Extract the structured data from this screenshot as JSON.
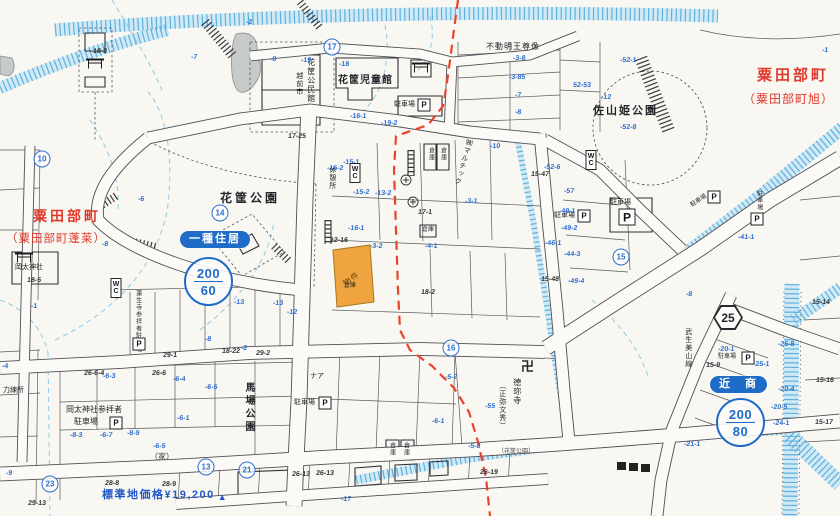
{
  "regions": {
    "top_right": {
      "name": "粟田部町",
      "sub": "（粟田部町旭）"
    },
    "west": {
      "name": "粟田部町",
      "sub": "（粟田部町蓬莱）"
    }
  },
  "zoning": {
    "residential": {
      "badge": "一種住居",
      "far": "200",
      "bcr": "60"
    },
    "commercial": {
      "badge": "近　商",
      "far": "200",
      "bcr": "80"
    }
  },
  "property": {
    "label": "物件"
  },
  "price_note": {
    "text": "標準地価格¥19,200",
    "marker": "▲"
  },
  "route_sign": "25",
  "colors": {
    "zone_blue": "#1f6bc8",
    "red_boundary": "#e8442c",
    "red_label": "#e0392b",
    "price_blue": "#2356c9",
    "water_blue": "#a9d8ee",
    "lot_number_blue": "#2e6fd0",
    "property_orange": "#f0a440"
  },
  "markers": {
    "p_label": "P",
    "wc_label": "WC",
    "pboxes": [
      {
        "x": 116,
        "y": 423
      },
      {
        "x": 139,
        "y": 344
      },
      {
        "x": 424,
        "y": 105
      },
      {
        "x": 584,
        "y": 216
      },
      {
        "x": 627,
        "y": 217,
        "s": 15
      },
      {
        "x": 325,
        "y": 403
      },
      {
        "x": 714,
        "y": 197
      },
      {
        "x": 757,
        "y": 219
      },
      {
        "x": 748,
        "y": 358
      }
    ],
    "wc": [
      {
        "x": 355,
        "y": 173
      },
      {
        "x": 116,
        "y": 288
      },
      {
        "x": 591,
        "y": 160
      }
    ],
    "torii": [
      {
        "x": 421,
        "y": 68
      },
      {
        "x": 95,
        "y": 64
      },
      {
        "x": 24,
        "y": 258
      }
    ],
    "circled": [
      {
        "t": "10",
        "x": 42,
        "y": 159
      },
      {
        "t": "17",
        "x": 332,
        "y": 47
      },
      {
        "t": "14",
        "x": 220,
        "y": 213
      },
      {
        "t": "15",
        "x": 621,
        "y": 257
      },
      {
        "t": "16",
        "x": 451,
        "y": 348
      },
      {
        "t": "13",
        "x": 206,
        "y": 467
      },
      {
        "t": "23",
        "x": 50,
        "y": 484
      },
      {
        "t": "21",
        "x": 247,
        "y": 470
      }
    ]
  },
  "labels": [
    {
      "text": "花筐児童館",
      "x": 338,
      "y": 75,
      "s": 10,
      "ls": 1,
      "b": 1
    },
    {
      "text": "越前市",
      "x": 295,
      "y": 72,
      "v": 1,
      "s": 7
    },
    {
      "text": "花筐公民館",
      "x": 306,
      "y": 58,
      "v": 1,
      "s": 8
    },
    {
      "text": "不動明王尊像",
      "x": 486,
      "y": 43,
      "s": 8,
      "ls": 1
    },
    {
      "text": "佐山姫公園",
      "x": 593,
      "y": 105,
      "s": 11,
      "ls": 2,
      "b": 1
    },
    {
      "text": "花筐公園",
      "x": 220,
      "y": 192,
      "s": 12,
      "ls": 3,
      "b": 1
    },
    {
      "text": "休憩所",
      "x": 328,
      "y": 166,
      "v": 1,
      "s": 7
    },
    {
      "text": "㈱マルチック",
      "x": 459,
      "y": 138,
      "v": 1,
      "s": 7,
      "rot": 16
    },
    {
      "text": "倉庫",
      "x": 422,
      "y": 227,
      "s": 6
    },
    {
      "text": "倉庫",
      "x": 344,
      "y": 283,
      "s": 6
    },
    {
      "text": "倉庫",
      "x": 427,
      "y": 147,
      "v": 1,
      "s": 6
    },
    {
      "text": "倉庫",
      "x": 439,
      "y": 147,
      "v": 1,
      "s": 6
    },
    {
      "text": "倉庫",
      "x": 388,
      "y": 442,
      "v": 1,
      "s": 6
    },
    {
      "text": "倉庫",
      "x": 402,
      "y": 442,
      "v": 1,
      "s": 6
    },
    {
      "text": "馬場公園",
      "x": 243,
      "y": 382,
      "v": 1,
      "s": 10,
      "ls": 3,
      "b": 1
    },
    {
      "text": "岡太神社参拝者",
      "x": 66,
      "y": 406,
      "s": 8
    },
    {
      "text": "駐車場",
      "x": 74,
      "y": 418,
      "s": 8
    },
    {
      "text": "蓮生寺参拝者駐車場",
      "x": 134,
      "y": 290,
      "v": 1,
      "s": 6
    },
    {
      "text": "岡太神社",
      "x": 15,
      "y": 264,
      "s": 7
    },
    {
      "text": "力練所",
      "x": 3,
      "y": 387,
      "s": 7
    },
    {
      "text": "（家）",
      "x": 150,
      "y": 453,
      "s": 8,
      "c": "#3c3c40"
    },
    {
      "text": "ナア",
      "x": 310,
      "y": 373,
      "s": 7
    },
    {
      "text": "德珎寺",
      "x": 512,
      "y": 378,
      "v": 1,
      "s": 8
    },
    {
      "text": "（正弥文秀）",
      "x": 498,
      "y": 382,
      "v": 1,
      "s": 7
    },
    {
      "text": "卍",
      "x": 521,
      "y": 360,
      "s": 13,
      "b": 1
    },
    {
      "text": "駐車場",
      "x": 394,
      "y": 101,
      "s": 7
    },
    {
      "text": "駐車場",
      "x": 554,
      "y": 212,
      "s": 7
    },
    {
      "text": "駐車場",
      "x": 610,
      "y": 199,
      "s": 7
    },
    {
      "text": "駐車場",
      "x": 294,
      "y": 399,
      "s": 7
    },
    {
      "text": "駐車場",
      "x": 690,
      "y": 198,
      "s": 6,
      "rot": -33
    },
    {
      "text": "駐車場",
      "x": 755,
      "y": 190,
      "v": 1,
      "s": 6
    },
    {
      "text": "駐車場",
      "x": 718,
      "y": 354,
      "s": 6
    },
    {
      "text": "武生美山線",
      "x": 684,
      "y": 328,
      "v": 1,
      "s": 7
    },
    {
      "text": "（花筐公園）",
      "x": 498,
      "y": 449,
      "s": 6,
      "c": "#4a4a4e"
    }
  ],
  "lots_blue": [
    {
      "t": "-2",
      "x": 246,
      "y": 19
    },
    {
      "t": "-7",
      "x": 191,
      "y": 54
    },
    {
      "t": "-8",
      "x": 270,
      "y": 56
    },
    {
      "t": "-19",
      "x": 301,
      "y": 57
    },
    {
      "t": "-18",
      "x": 339,
      "y": 61
    },
    {
      "t": "-3-8",
      "x": 513,
      "y": 55
    },
    {
      "t": "-3-85",
      "x": 509,
      "y": 74
    },
    {
      "t": "-7",
      "x": 515,
      "y": 92
    },
    {
      "t": "-8",
      "x": 515,
      "y": 109
    },
    {
      "t": "-10",
      "x": 490,
      "y": 143
    },
    {
      "t": "-12",
      "x": 601,
      "y": 94
    },
    {
      "t": "-52-1",
      "x": 620,
      "y": 57
    },
    {
      "t": "52-53",
      "x": 573,
      "y": 82
    },
    {
      "t": "-52-8",
      "x": 620,
      "y": 124
    },
    {
      "t": "-16-1",
      "x": 350,
      "y": 113
    },
    {
      "t": "-19-2",
      "x": 381,
      "y": 120
    },
    {
      "t": "-52-6",
      "x": 544,
      "y": 164
    },
    {
      "t": "-57",
      "x": 564,
      "y": 188
    },
    {
      "t": "-49-1",
      "x": 559,
      "y": 208
    },
    {
      "t": "-49-2",
      "x": 561,
      "y": 225
    },
    {
      "t": "-46-1",
      "x": 545,
      "y": 240
    },
    {
      "t": "-44-3",
      "x": 564,
      "y": 251
    },
    {
      "t": "-49-4",
      "x": 568,
      "y": 278
    },
    {
      "t": "-41-1",
      "x": 738,
      "y": 234
    },
    {
      "t": "-20-1",
      "x": 718,
      "y": 346
    },
    {
      "t": "-25-1",
      "x": 753,
      "y": 361
    },
    {
      "t": "-25-8",
      "x": 778,
      "y": 341
    },
    {
      "t": "-20-4",
      "x": 778,
      "y": 386
    },
    {
      "t": "-20-5",
      "x": 771,
      "y": 404
    },
    {
      "t": "-24-1",
      "x": 773,
      "y": 420
    },
    {
      "t": "-21-1",
      "x": 684,
      "y": 441
    },
    {
      "t": "-15-1",
      "x": 343,
      "y": 159
    },
    {
      "t": "-15-2",
      "x": 327,
      "y": 165
    },
    {
      "t": "-15-2",
      "x": 353,
      "y": 189
    },
    {
      "t": "-13-2",
      "x": 375,
      "y": 190
    },
    {
      "t": "-16-1",
      "x": 348,
      "y": 225
    },
    {
      "t": "-3-2",
      "x": 370,
      "y": 243
    },
    {
      "t": "-4-1",
      "x": 425,
      "y": 243
    },
    {
      "t": "-3-1",
      "x": 465,
      "y": 198
    },
    {
      "t": "-5-7",
      "x": 445,
      "y": 374
    },
    {
      "t": "-55",
      "x": 485,
      "y": 403
    },
    {
      "t": "-6-1",
      "x": 432,
      "y": 418
    },
    {
      "t": "-5-8",
      "x": 468,
      "y": 443
    },
    {
      "t": "-6-3",
      "x": 103,
      "y": 373
    },
    {
      "t": "-6-4",
      "x": 173,
      "y": 376
    },
    {
      "t": "-6-5",
      "x": 205,
      "y": 384
    },
    {
      "t": "-6-1",
      "x": 177,
      "y": 415
    },
    {
      "t": "-6-5",
      "x": 153,
      "y": 443
    },
    {
      "t": "-8-3",
      "x": 70,
      "y": 432
    },
    {
      "t": "-6-7",
      "x": 100,
      "y": 432
    },
    {
      "t": "-8-9",
      "x": 127,
      "y": 430
    },
    {
      "t": "-4",
      "x": 2,
      "y": 363
    },
    {
      "t": "-9",
      "x": 6,
      "y": 470
    },
    {
      "t": "-13",
      "x": 234,
      "y": 299
    },
    {
      "t": "-13",
      "x": 273,
      "y": 300
    },
    {
      "t": "-12",
      "x": 287,
      "y": 309
    },
    {
      "t": "-8",
      "x": 205,
      "y": 336
    },
    {
      "t": "-2",
      "x": 241,
      "y": 345
    },
    {
      "t": "-6",
      "x": 138,
      "y": 196
    },
    {
      "t": "-8",
      "x": 102,
      "y": 241
    },
    {
      "t": "-1",
      "x": 31,
      "y": 303
    },
    {
      "t": "-17",
      "x": 341,
      "y": 496
    },
    {
      "t": "-8",
      "x": 686,
      "y": 291
    },
    {
      "t": "-1",
      "x": 822,
      "y": 47
    }
  ],
  "lots_black": [
    {
      "t": "17-25",
      "x": 288,
      "y": 133
    },
    {
      "t": "17-1",
      "x": 418,
      "y": 209
    },
    {
      "t": "12-16",
      "x": 330,
      "y": 237
    },
    {
      "t": "18-2",
      "x": 421,
      "y": 289
    },
    {
      "t": "15-47",
      "x": 531,
      "y": 171
    },
    {
      "t": "15-48",
      "x": 541,
      "y": 276
    },
    {
      "t": "26-6-4",
      "x": 84,
      "y": 370
    },
    {
      "t": "26-6",
      "x": 152,
      "y": 370
    },
    {
      "t": "28-8",
      "x": 105,
      "y": 480
    },
    {
      "t": "28-9",
      "x": 162,
      "y": 481
    },
    {
      "t": "18-22",
      "x": 222,
      "y": 348
    },
    {
      "t": "29-2",
      "x": 256,
      "y": 350
    },
    {
      "t": "29-1",
      "x": 163,
      "y": 352
    },
    {
      "t": "26-13",
      "x": 292,
      "y": 471
    },
    {
      "t": "26-13",
      "x": 316,
      "y": 470
    },
    {
      "t": "26-19",
      "x": 480,
      "y": 469
    },
    {
      "t": "15-14",
      "x": 812,
      "y": 299
    },
    {
      "t": "15-16",
      "x": 816,
      "y": 377
    },
    {
      "t": "15-17",
      "x": 815,
      "y": 419
    },
    {
      "t": "15-9",
      "x": 706,
      "y": 362
    },
    {
      "t": "18-3",
      "x": 93,
      "y": 48
    },
    {
      "t": "18-5",
      "x": 27,
      "y": 277
    },
    {
      "t": "29-13",
      "x": 28,
      "y": 500
    }
  ]
}
